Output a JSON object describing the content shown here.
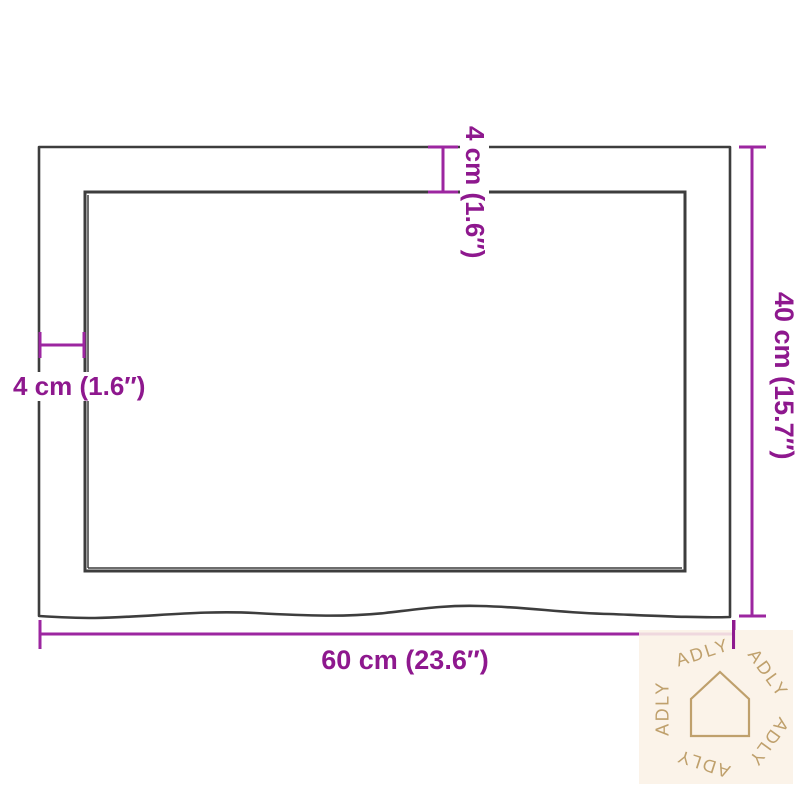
{
  "diagram": {
    "type": "dimension-drawing",
    "subject": "rectangular table top with live edge, top view",
    "outline_color": "#3d3d3d",
    "dimension_color": "#8e188e",
    "labels": {
      "top": "4 cm (1.6″)",
      "left": "4 cm (1.6″)",
      "right": "40 cm (15.7″)",
      "bottom": "60 cm (23.6″)"
    },
    "measurements": {
      "width_cm": 60,
      "width_in": 23.6,
      "depth_cm": 40,
      "depth_in": 15.7,
      "edge_cm": 4,
      "edge_in": 1.6
    }
  },
  "watermark": {
    "brand": "ADLY",
    "background": "#faf1e6",
    "foreground": "#bfa06c",
    "icon": "house-outline-icon",
    "words": [
      "ADLY",
      "ADLY",
      "ADLY",
      "ADLY",
      "ADLY"
    ]
  }
}
